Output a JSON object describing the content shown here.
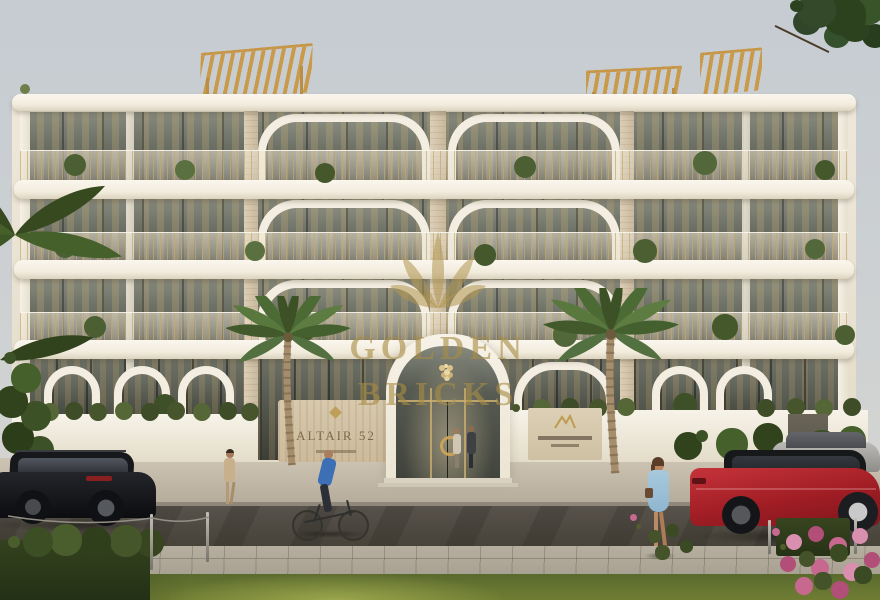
{
  "scene": {
    "type": "architectural-exterior-render",
    "subject": "low-rise residential apartment building with street, palm trees, pedestrians and parked cars"
  },
  "watermark": {
    "line1": "GOLDEN",
    "line2": "BRICKS",
    "logo_icon": "lotus-crown-icon",
    "color": "#b2974e"
  },
  "signs": {
    "entrance_wall_name": "ALTAIR 52",
    "realty_sign_logo_icon": "arches-icon"
  },
  "palette": {
    "sky": "#cbd0d3",
    "facade": "#ece4d4",
    "slab_white": "#f7f3ea",
    "beige_panel": "#d5c6ae",
    "gold_accent": "#c89a4a",
    "glass": "#5d6057",
    "greenery": "#4c5f33",
    "road": "#514c45",
    "sidewalk": "#b3aa9b",
    "grass": "#687631",
    "red_car": "#b02228",
    "black_car": "#101215",
    "flower_pink": "#c7688f"
  }
}
